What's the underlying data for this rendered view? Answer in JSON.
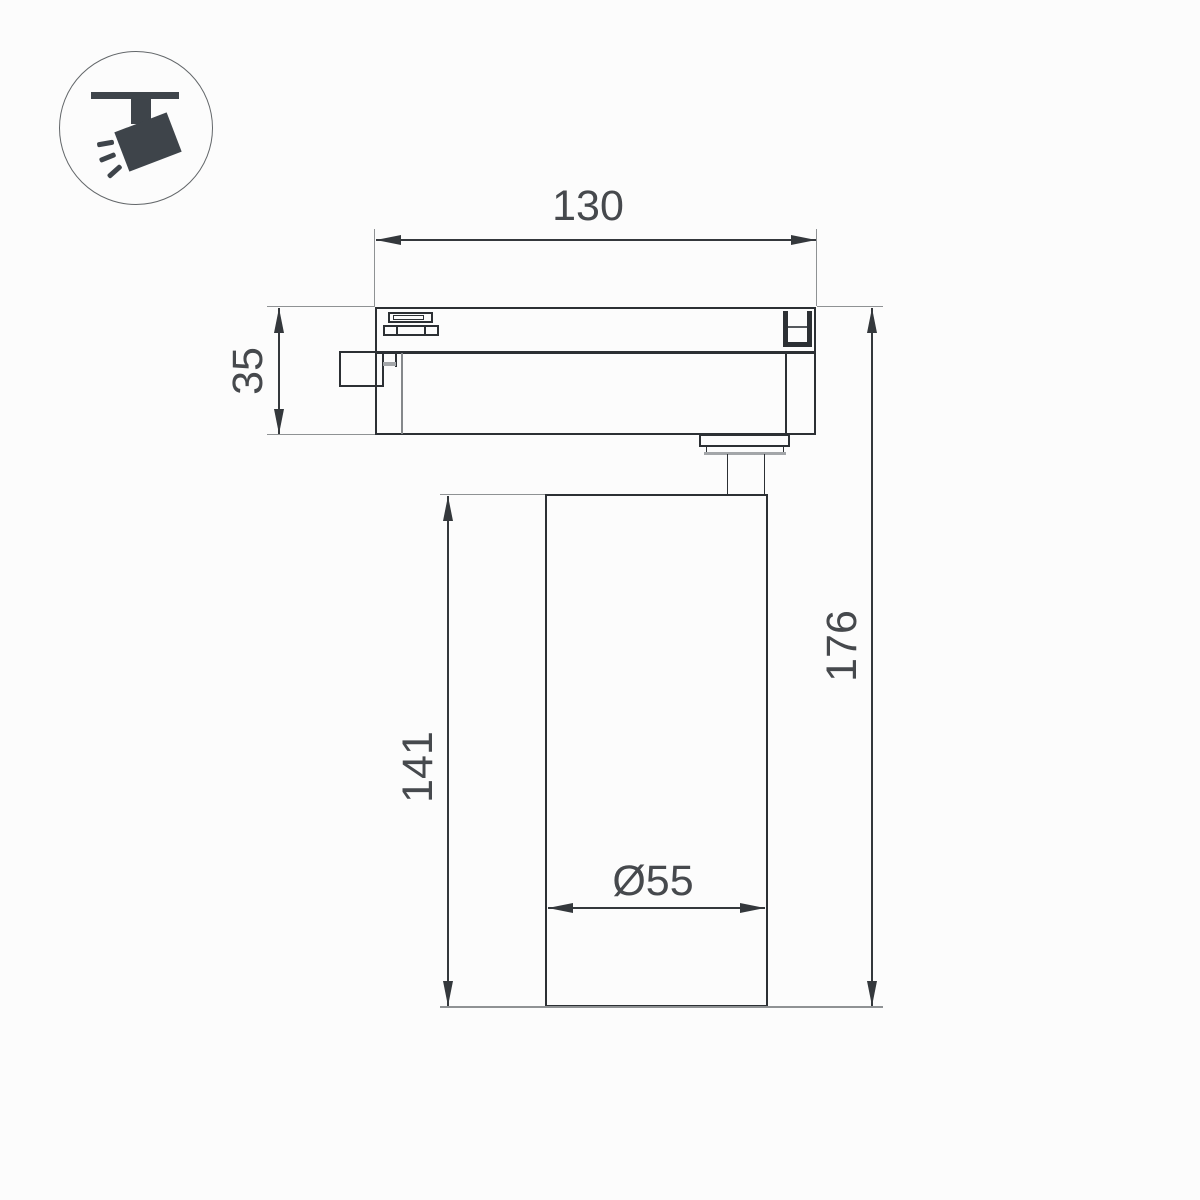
{
  "page": {
    "background": "#fcfcfc"
  },
  "icon": {
    "name": "track-spotlight-icon",
    "color": "#3e444a"
  },
  "dims": {
    "width": "130",
    "adapter_height": "35",
    "body_height": "141",
    "total_height": "176",
    "diameter": "Ø55"
  },
  "colors": {
    "outline": "#2c3034",
    "dimension_line": "#34383c",
    "extension_line": "#8f9294",
    "text": "#46494d"
  }
}
